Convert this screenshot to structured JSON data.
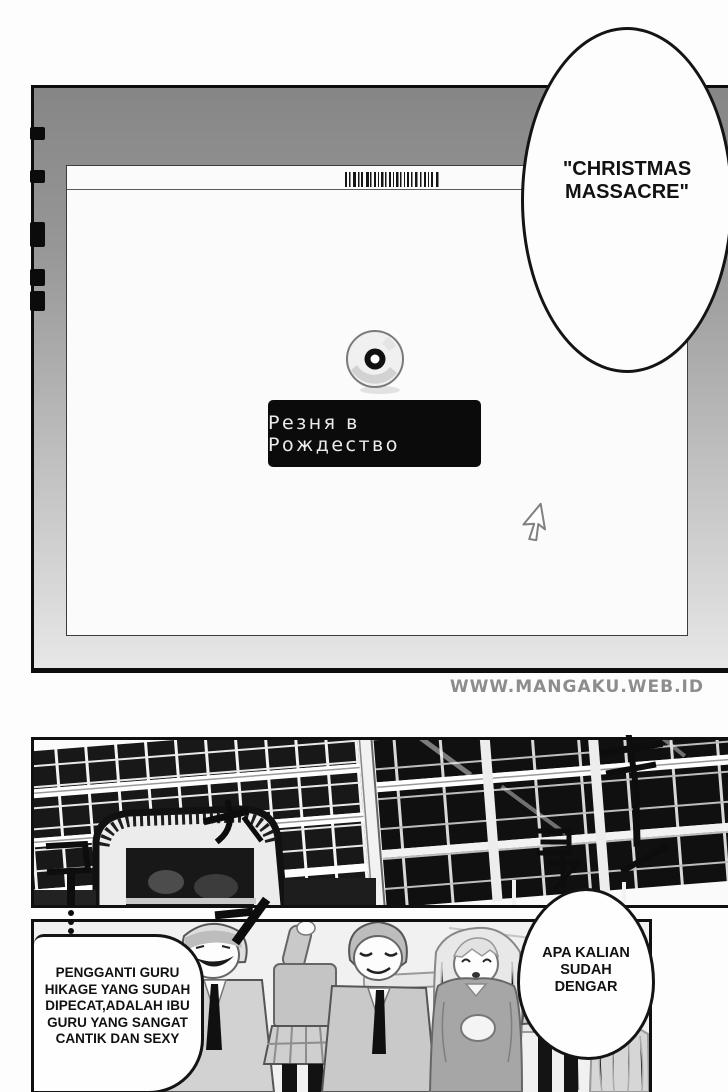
{
  "watermark": {
    "text": "WWW.MANGAKU.WEB.ID"
  },
  "monitor": {
    "video_title": {
      "text": "Резня в Рождество"
    }
  },
  "dialogue": {
    "christmas_bubble": {
      "lines": [
        "\"CHRISTMAS",
        "MASSACRE\""
      ]
    },
    "caption_box": {
      "lines": [
        "PENGGANTI GURU",
        "HIKAGE YANG SUDAH",
        "DIPECAT,ADALAH IBU",
        "GURU YANG SANGAT",
        "CANTIK DAN SEXY"
      ]
    },
    "question_bubble": {
      "lines": [
        "APA KALIAN",
        "SUDAH",
        "DENGAR"
      ]
    }
  },
  "sound_effects": {
    "left": "カ コ …",
    "right": "キ ヨ ォ ー"
  },
  "colors": {
    "panel_border": "#101010",
    "bezel_top": "#868686",
    "bezel_bottom": "#e7e7e7",
    "screen_bg": "#fbfbfb",
    "title_box_bg": "#0b0b0b",
    "title_box_text": "#ececec",
    "watermark": "#8d8d8d"
  }
}
